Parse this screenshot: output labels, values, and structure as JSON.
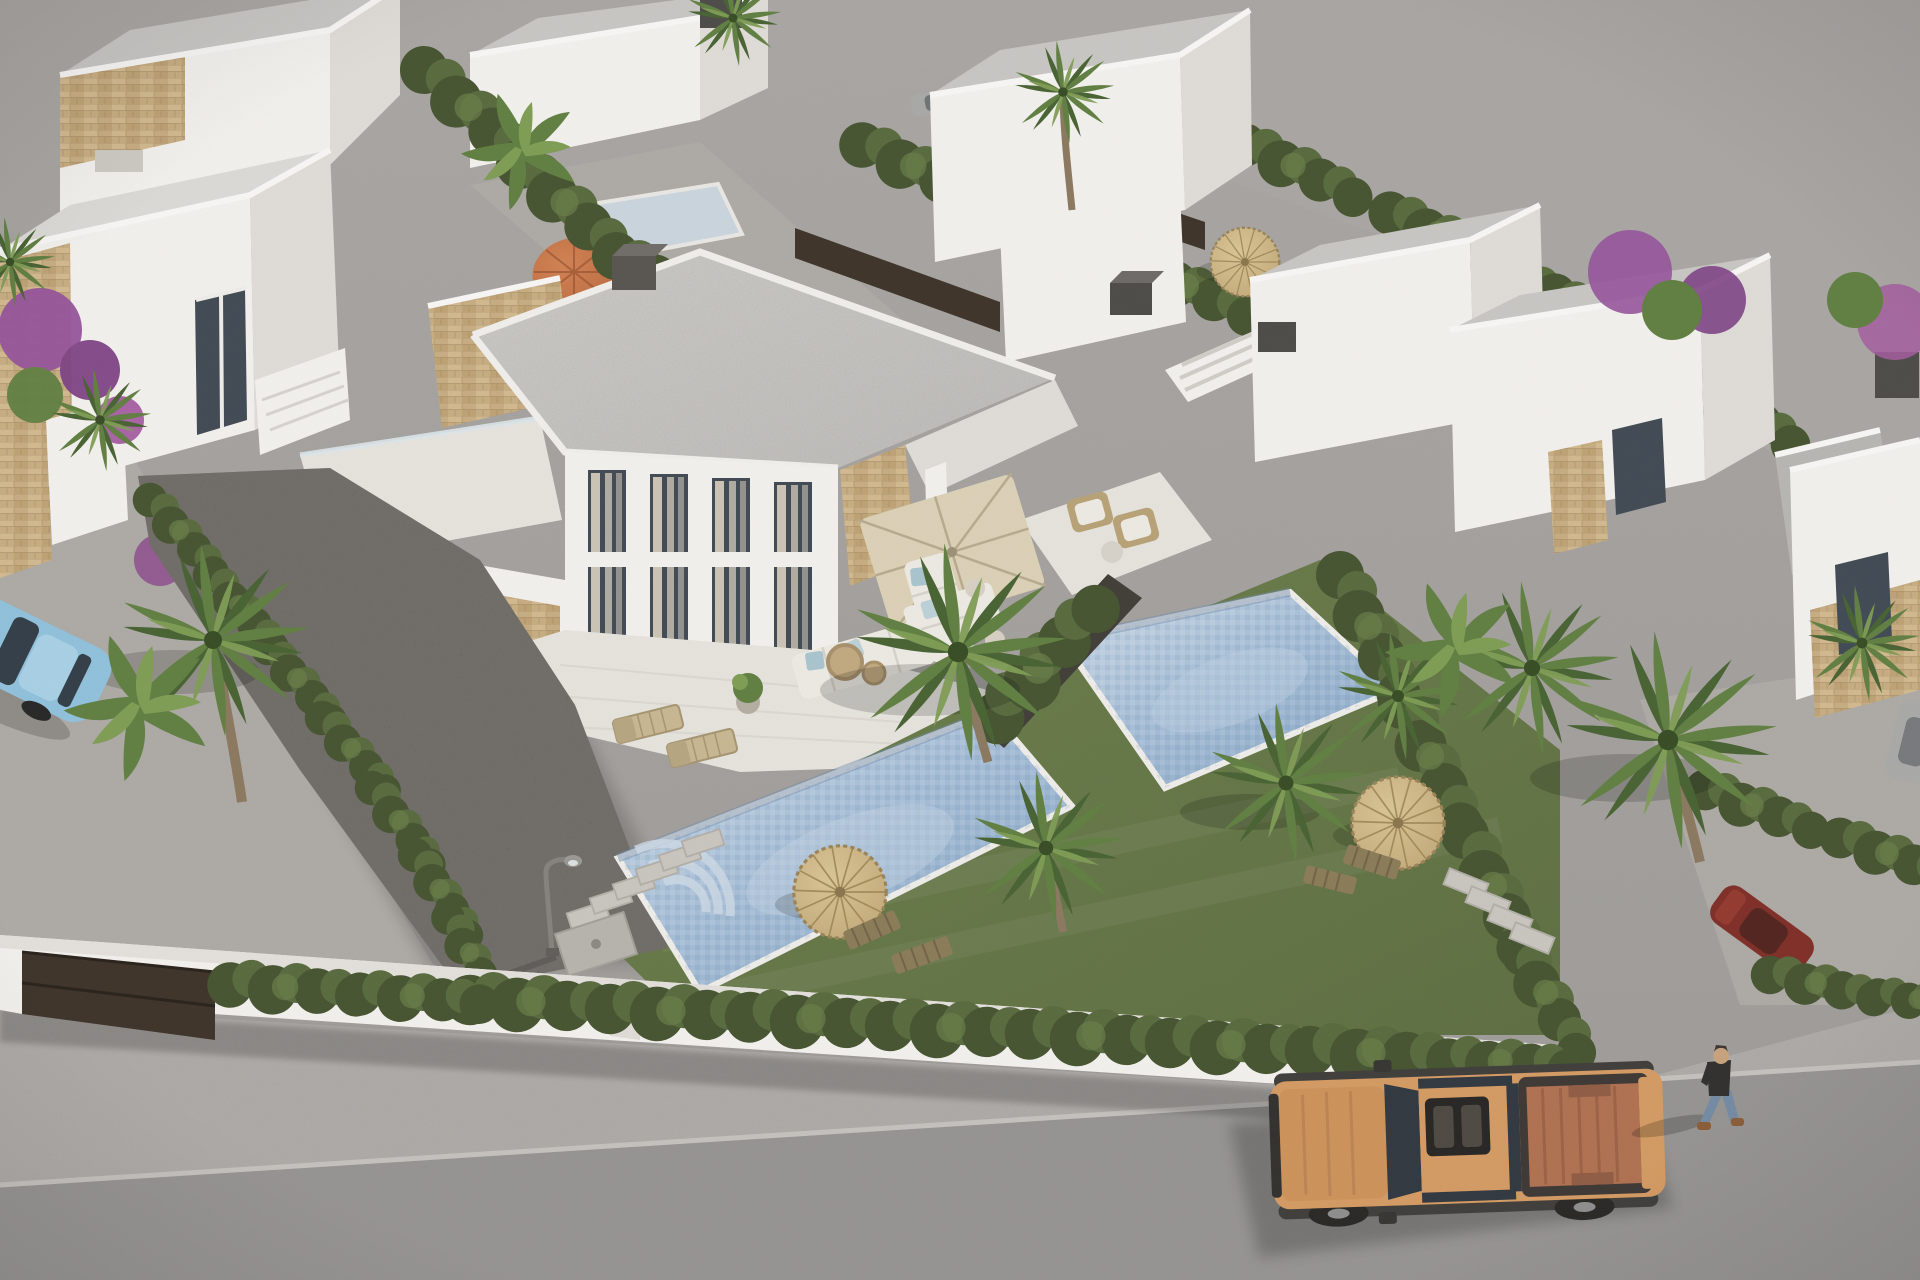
{
  "scene": {
    "type": "3d architectural render",
    "description": "Aerial view of a modern white villa development: a two-storey duplex villa with sandstone feature walls, two private mosaic pools, lawned gardens with straw parasols and palm trees, surrounded by identical flat-roofed villas, a perimeter wall with a dark gate, and a street with an orange pickup truck, parked cars and a pedestrian",
    "camera": "high oblique aerial",
    "lighting": "bright daylight, sun from upper right"
  },
  "palette": {
    "ground": "#9d9a97",
    "ground-light": "#a9a6a3",
    "road": "#8f8d8b",
    "sidewalk": "#b9b5b0",
    "path": "#aeaaa5",
    "wall-white": "#f6f4f0",
    "wall-shade": "#e2dfda",
    "wall-dark": "#cfccc6",
    "roof": "#cac8c5",
    "roof-light": "#dedcd8",
    "terrace": "#e9e6e0",
    "stone-tan": "#c9ad80",
    "stone-dark": "#a98f63",
    "glass": "#3d4751",
    "curtain": "#cdc5b6",
    "hedge-dark": "#42512c",
    "hedge-mid": "#55683a",
    "hedge-light": "#677c45",
    "grass": "#5b6d3e",
    "grass-light": "#6a7d48",
    "gravel": "#605c56",
    "pool": "#a6bfd9",
    "pool-deep": "#86a6c8",
    "pool-light": "#cddbe9",
    "palm-dark": "#44602e",
    "palm-mid": "#5e7e3e",
    "palm-light": "#7e9d52",
    "straw": "#c4aa78",
    "straw-dark": "#9a8254",
    "terracotta": "#c06a3e",
    "wood": "#b9a275",
    "furniture-white": "#f0ede6",
    "cushion-blue": "#a9c6cf",
    "fence-brown": "#3a2f25",
    "truck-orange": "#d69a60",
    "truck-bed": "#b06f4e",
    "car-blue": "#8fc2de",
    "car-red": "#7e2a22",
    "car-silver": "#a9a9a7",
    "skin": "#c9a27b",
    "denim": "#7289a4",
    "shirt": "#2d2b29",
    "bougainvillea": "#96519b"
  },
  "objects": {
    "development": {
      "label": "modern villa residential development"
    },
    "hero_villa": {
      "label": "two-storey duplex villa",
      "features": [
        "floor-to-ceiling curtained windows",
        "sandstone feature walls",
        "roof terrace with glass balustrade",
        "covered dining terrace with beige parasol",
        "white outdoor corner sofa with blue cushions",
        "dark grey chimney"
      ]
    },
    "pools": [
      {
        "label": "left unit private mosaic pool with roman steps"
      },
      {
        "label": "right unit private mosaic pool"
      }
    ],
    "neighbour_villas": {
      "label": "white flat-roofed villas with roof terraces, external stairs and chimneys",
      "count": "10"
    },
    "vehicles": [
      {
        "label": "orange pickup truck on street",
        "color-key": "truck-orange"
      },
      {
        "label": "light blue car on side lane",
        "color-key": "car-blue"
      },
      {
        "label": "dark red parked car behind hedge",
        "color-key": "car-red"
      },
      {
        "label": "dark red parked car in rear lane",
        "color-key": "car-red"
      },
      {
        "label": "silver parked car in rear lane",
        "color-key": "car-silver"
      }
    ],
    "person": {
      "label": "pedestrian walking along the street"
    },
    "landscaping": {
      "fan_palms": "12",
      "banana_plants": "3",
      "straw_parasols": "3",
      "terracotta_parasol": "1",
      "sun_loungers": "4",
      "deck_chairs": "4",
      "hedgerows": "perimeter and garden cypress hedges",
      "lawn": "two lawned pool gardens",
      "gravel_garden": "dark gravel side garden",
      "bougainvillea": "purple flowering shrubs"
    },
    "street_furniture": {
      "lamps": "2 curved street lamps",
      "stepping_stones": "2 paths",
      "gate": "dark brown entrance gate in white perimeter wall"
    }
  }
}
